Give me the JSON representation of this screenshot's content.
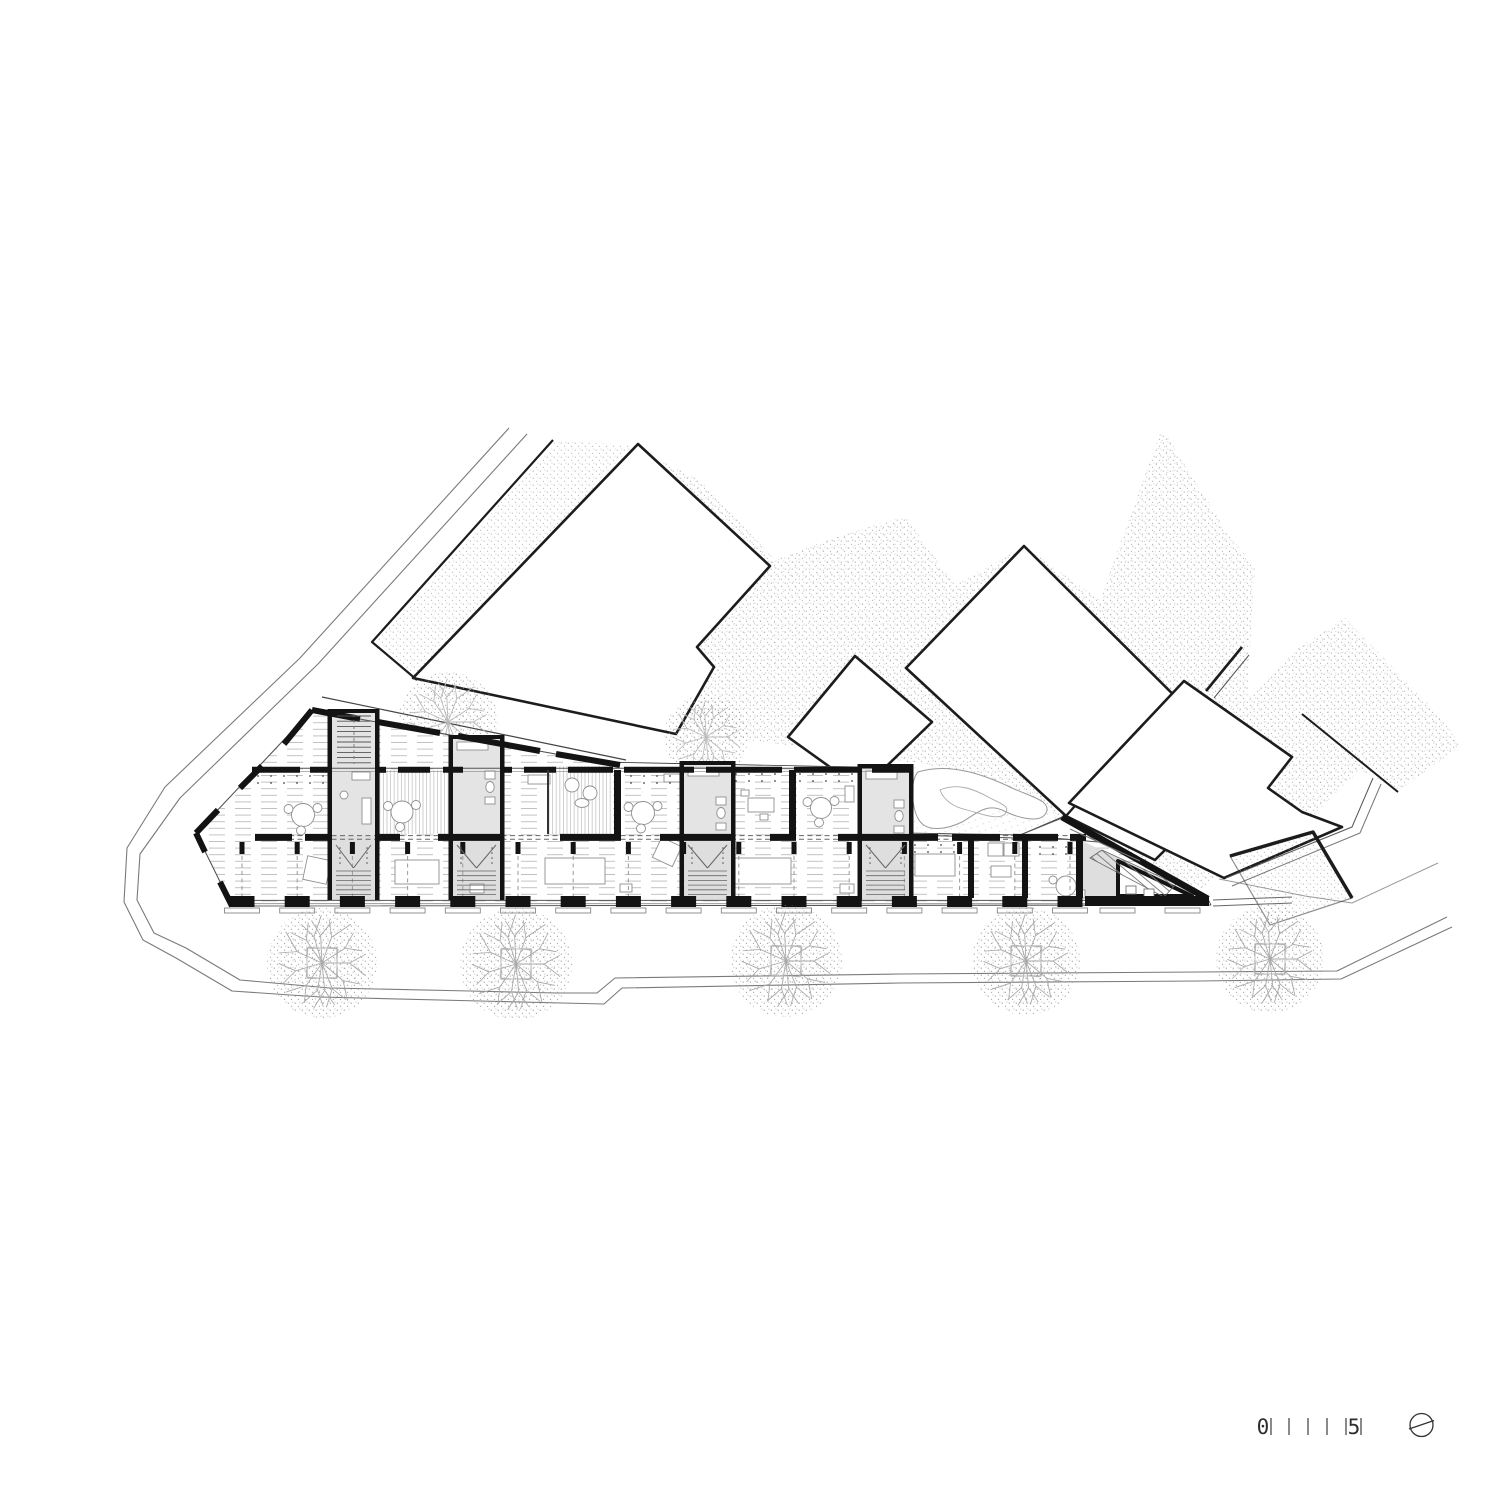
{
  "drawing": {
    "type": "architectural-site-plan",
    "description": "Ground floor plan of a terraced housing row with stair cores, terraces, rear garden with pond, neighbouring buildings and tree-lined street"
  },
  "scale_bar": {
    "start_label": "0",
    "end_label": "5",
    "tick_positions": [
      1271,
      1289,
      1308,
      1327,
      1346,
      1361
    ]
  },
  "north_arrow": {
    "icon": "north-indicator-circle"
  },
  "colors": {
    "paper": "#ffffff",
    "ink": "#1c1c1c",
    "wall": "#131313",
    "core_fill": "#dedede",
    "bath_fill": "#e4e4e4",
    "furniture": "#8f8f8f",
    "floorline": "#9a9a9a",
    "hatch": "#b9b9b9",
    "stipple": "#8d8d8d",
    "veg": "#aaaaaa",
    "road": "#7a7a7a"
  },
  "site": {
    "street_tree_count": 5,
    "garden_tree_count": 2,
    "neighbor_building_count": 4,
    "stair_core_count": 5,
    "residential_unit_count": 6
  }
}
